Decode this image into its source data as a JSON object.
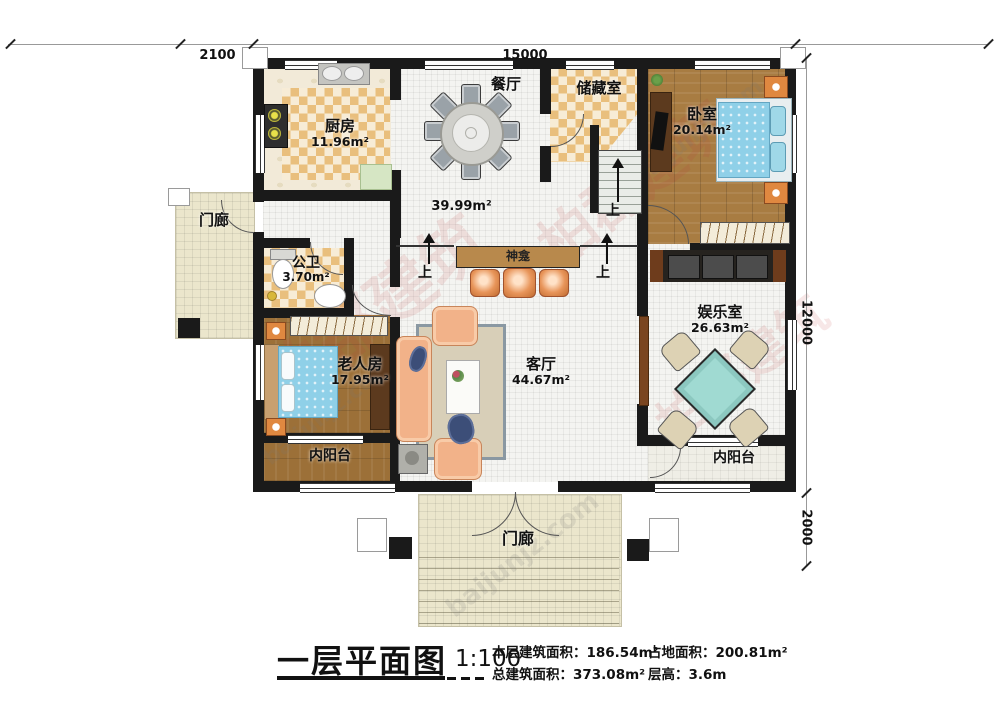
{
  "dims": {
    "d2100": "2100",
    "d15000": "15000",
    "d12000": "12000",
    "d2000": "2000"
  },
  "rooms": {
    "kitchen": {
      "name": "厨房",
      "area": "11.96m²"
    },
    "dining": {
      "name": "餐厅"
    },
    "storage": {
      "name": "储藏室"
    },
    "bedroom": {
      "name": "卧室",
      "area": "20.14m²"
    },
    "hall": {
      "area": "39.99m²"
    },
    "porch_left": {
      "name": "门廊"
    },
    "bath": {
      "name": "公卫",
      "area": "3.70m²"
    },
    "elder": {
      "name": "老人房",
      "area": "17.95m²"
    },
    "living": {
      "name": "客厅",
      "area": "44.67m²"
    },
    "shrine": {
      "name": "神龛"
    },
    "entertainment": {
      "name": "娱乐室",
      "area": "26.63m²"
    },
    "balcony_left": {
      "name": "内阳台"
    },
    "balcony_right": {
      "name": "内阳台"
    },
    "porch_bottom": {
      "name": "门廊"
    },
    "up": "上"
  },
  "legend": {
    "title": "一层平面图",
    "scale": "1:100",
    "stats": [
      {
        "label": "本层建筑面积：",
        "value": "186.54m²"
      },
      {
        "label": "占地面积：",
        "value": "200.81m²"
      },
      {
        "label": "总建筑面积：",
        "value": "373.08m²"
      },
      {
        "label": "层高：",
        "value": "3.6m"
      }
    ]
  },
  "watermark": {
    "cn": "柏郡建筑",
    "en": "baijunjz.com"
  },
  "colors": {
    "wall": "#1a1a1a",
    "checker": "#e9bf7d",
    "wood": "#a87c42",
    "bed_blue": "#8fd0e8",
    "accent_orange": "#e8955a",
    "mahjong_teal": "#a0dad2"
  }
}
